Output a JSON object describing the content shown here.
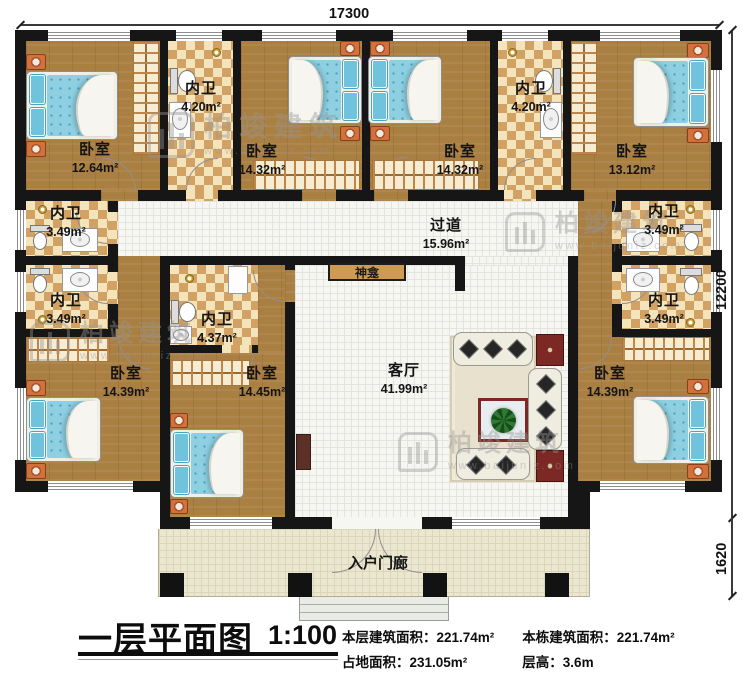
{
  "rooms": {
    "bedroom_tl": {
      "name": "卧室",
      "area": "12.64m²"
    },
    "bath_top1": {
      "name": "内卫",
      "area": "4.20m²"
    },
    "bedroom_tm_left": {
      "name": "卧室",
      "area": "14.32m²"
    },
    "bedroom_tm_right": {
      "name": "卧室",
      "area": "14.32m²"
    },
    "bath_top2": {
      "name": "内卫",
      "area": "4.20m²"
    },
    "bedroom_tr": {
      "name": "卧室",
      "area": "13.12m²"
    },
    "bath_left1": {
      "name": "内卫",
      "area": "3.49m²"
    },
    "bath_left2": {
      "name": "内卫",
      "area": "3.49m²"
    },
    "hallway": {
      "name": "过道",
      "area": "15.96m²"
    },
    "bath_right1": {
      "name": "内卫",
      "area": "3.49m²"
    },
    "bath_right2": {
      "name": "内卫",
      "area": "3.49m²"
    },
    "bedroom_bl": {
      "name": "卧室",
      "area": "14.39m²"
    },
    "bath_center": {
      "name": "内卫",
      "area": "4.37m²"
    },
    "bedroom_bm": {
      "name": "卧室",
      "area": "14.45m²"
    },
    "living_room": {
      "name": "客厅",
      "area": "41.99m²"
    },
    "shrine": {
      "name": "神龛"
    },
    "bedroom_br": {
      "name": "卧室",
      "area": "14.39m²"
    },
    "porch": {
      "name": "入户门廊"
    }
  },
  "dimensions": {
    "top": "17300",
    "right_main": "12200",
    "right_porch": "1620"
  },
  "title_block": {
    "title": "一层平面图",
    "scale": "1:100",
    "stats": [
      {
        "label": "本层建筑面积：",
        "value": "221.74m²"
      },
      {
        "label": "本栋建筑面积：",
        "value": "221.74m²"
      },
      {
        "label": "占地面积：",
        "value": "231.05m²"
      },
      {
        "label": "层高：",
        "value": "3.6m"
      }
    ]
  },
  "watermark": {
    "brand": "柏竣建筑",
    "url": "www.baijuniz.com"
  },
  "colors": {
    "wall": "#161616",
    "wood_floor": "#aa7f42",
    "tile_light": "#f4e4bc",
    "tile_dark": "#d2a264",
    "bed_blue": "#8ed0e2",
    "nightstand_orange": "#d2713c",
    "shrine_tan": "#cf9a52",
    "table_red": "#7c2824"
  }
}
